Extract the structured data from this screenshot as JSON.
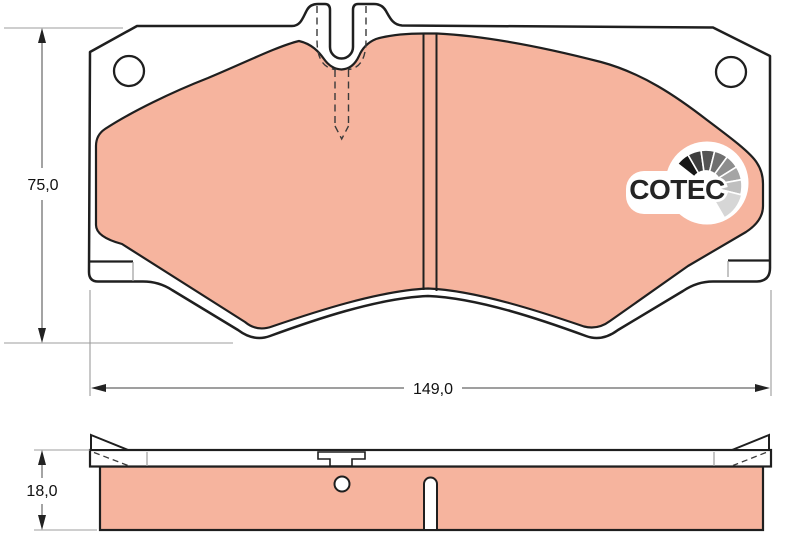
{
  "drawing": {
    "kind": "brake-pad technical drawing, front view and edge view",
    "dimensions": {
      "height": {
        "label": "75,0"
      },
      "width": {
        "label": "149,0"
      },
      "thickness": {
        "label": "18,0"
      }
    },
    "logo": {
      "text": "COTEC",
      "fan_colors": [
        "#171717",
        "#3e3e3e",
        "#545454",
        "#6f6f6f",
        "#8d8d8d",
        "#a5a5a5",
        "#bfbfbf",
        "#d6d6d6"
      ]
    },
    "colors": {
      "friction": "#f6b49e",
      "outline": "#1f1f1f",
      "backplate": "#ffffff",
      "thin_line": "#9c9c9c",
      "dim_line": "#666666",
      "text": "#111111",
      "logo_text": "#242424"
    }
  }
}
